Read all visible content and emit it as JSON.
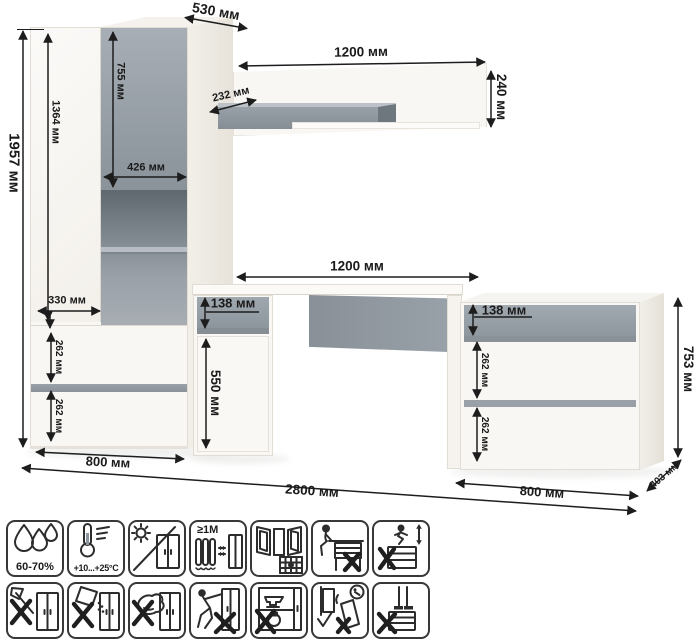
{
  "dims": {
    "wardrobe_depth": "530 мм",
    "total_height": "1957 мм",
    "left_door_height": "1364 мм",
    "upper_door_height": "755 мм",
    "upper_door_width": "426 мм",
    "shelf_depth": "232 мм",
    "shelf_length": "1200 мм",
    "shelf_height": "240 мм",
    "desk_length": "1200 мм",
    "desk_drawer_height": "138 мм",
    "desk_door_height": "550 мм",
    "niche_width": "330 мм",
    "wardrobe_drawer_1": "262 мм",
    "wardrobe_drawer_2": "262 мм",
    "wardrobe_width": "800 мм",
    "total_width": "2800 мм",
    "dresser_drawer_top": "138 мм",
    "dresser_drawer_1": "262 мм",
    "dresser_drawer_2": "262 мм",
    "dresser_width": "800 мм",
    "dresser_depth": "403 мм",
    "dresser_height": "753 мм"
  },
  "care_icons": {
    "humidity": "60-70%",
    "temperature": "+10...+25°C",
    "distance": "≥1М",
    "items": [
      "humidity-60-70",
      "temperature-range",
      "no-direct-sunlight",
      "min-1m-from-heat-sources",
      "ventilated-room",
      "no-sitting-on-furniture",
      "no-jumping-on-furniture",
      "no-sharp-tools",
      "no-abrasive-powders",
      "no-wet-scrubbing",
      "no-dragging",
      "no-heavy-items-inside",
      "anchor-to-wall",
      "no-standing-on-furniture"
    ]
  },
  "colors": {
    "accent_gray": "#99a1a8",
    "line": "#1d1d1d",
    "furniture_white": "#f9f7f3"
  }
}
